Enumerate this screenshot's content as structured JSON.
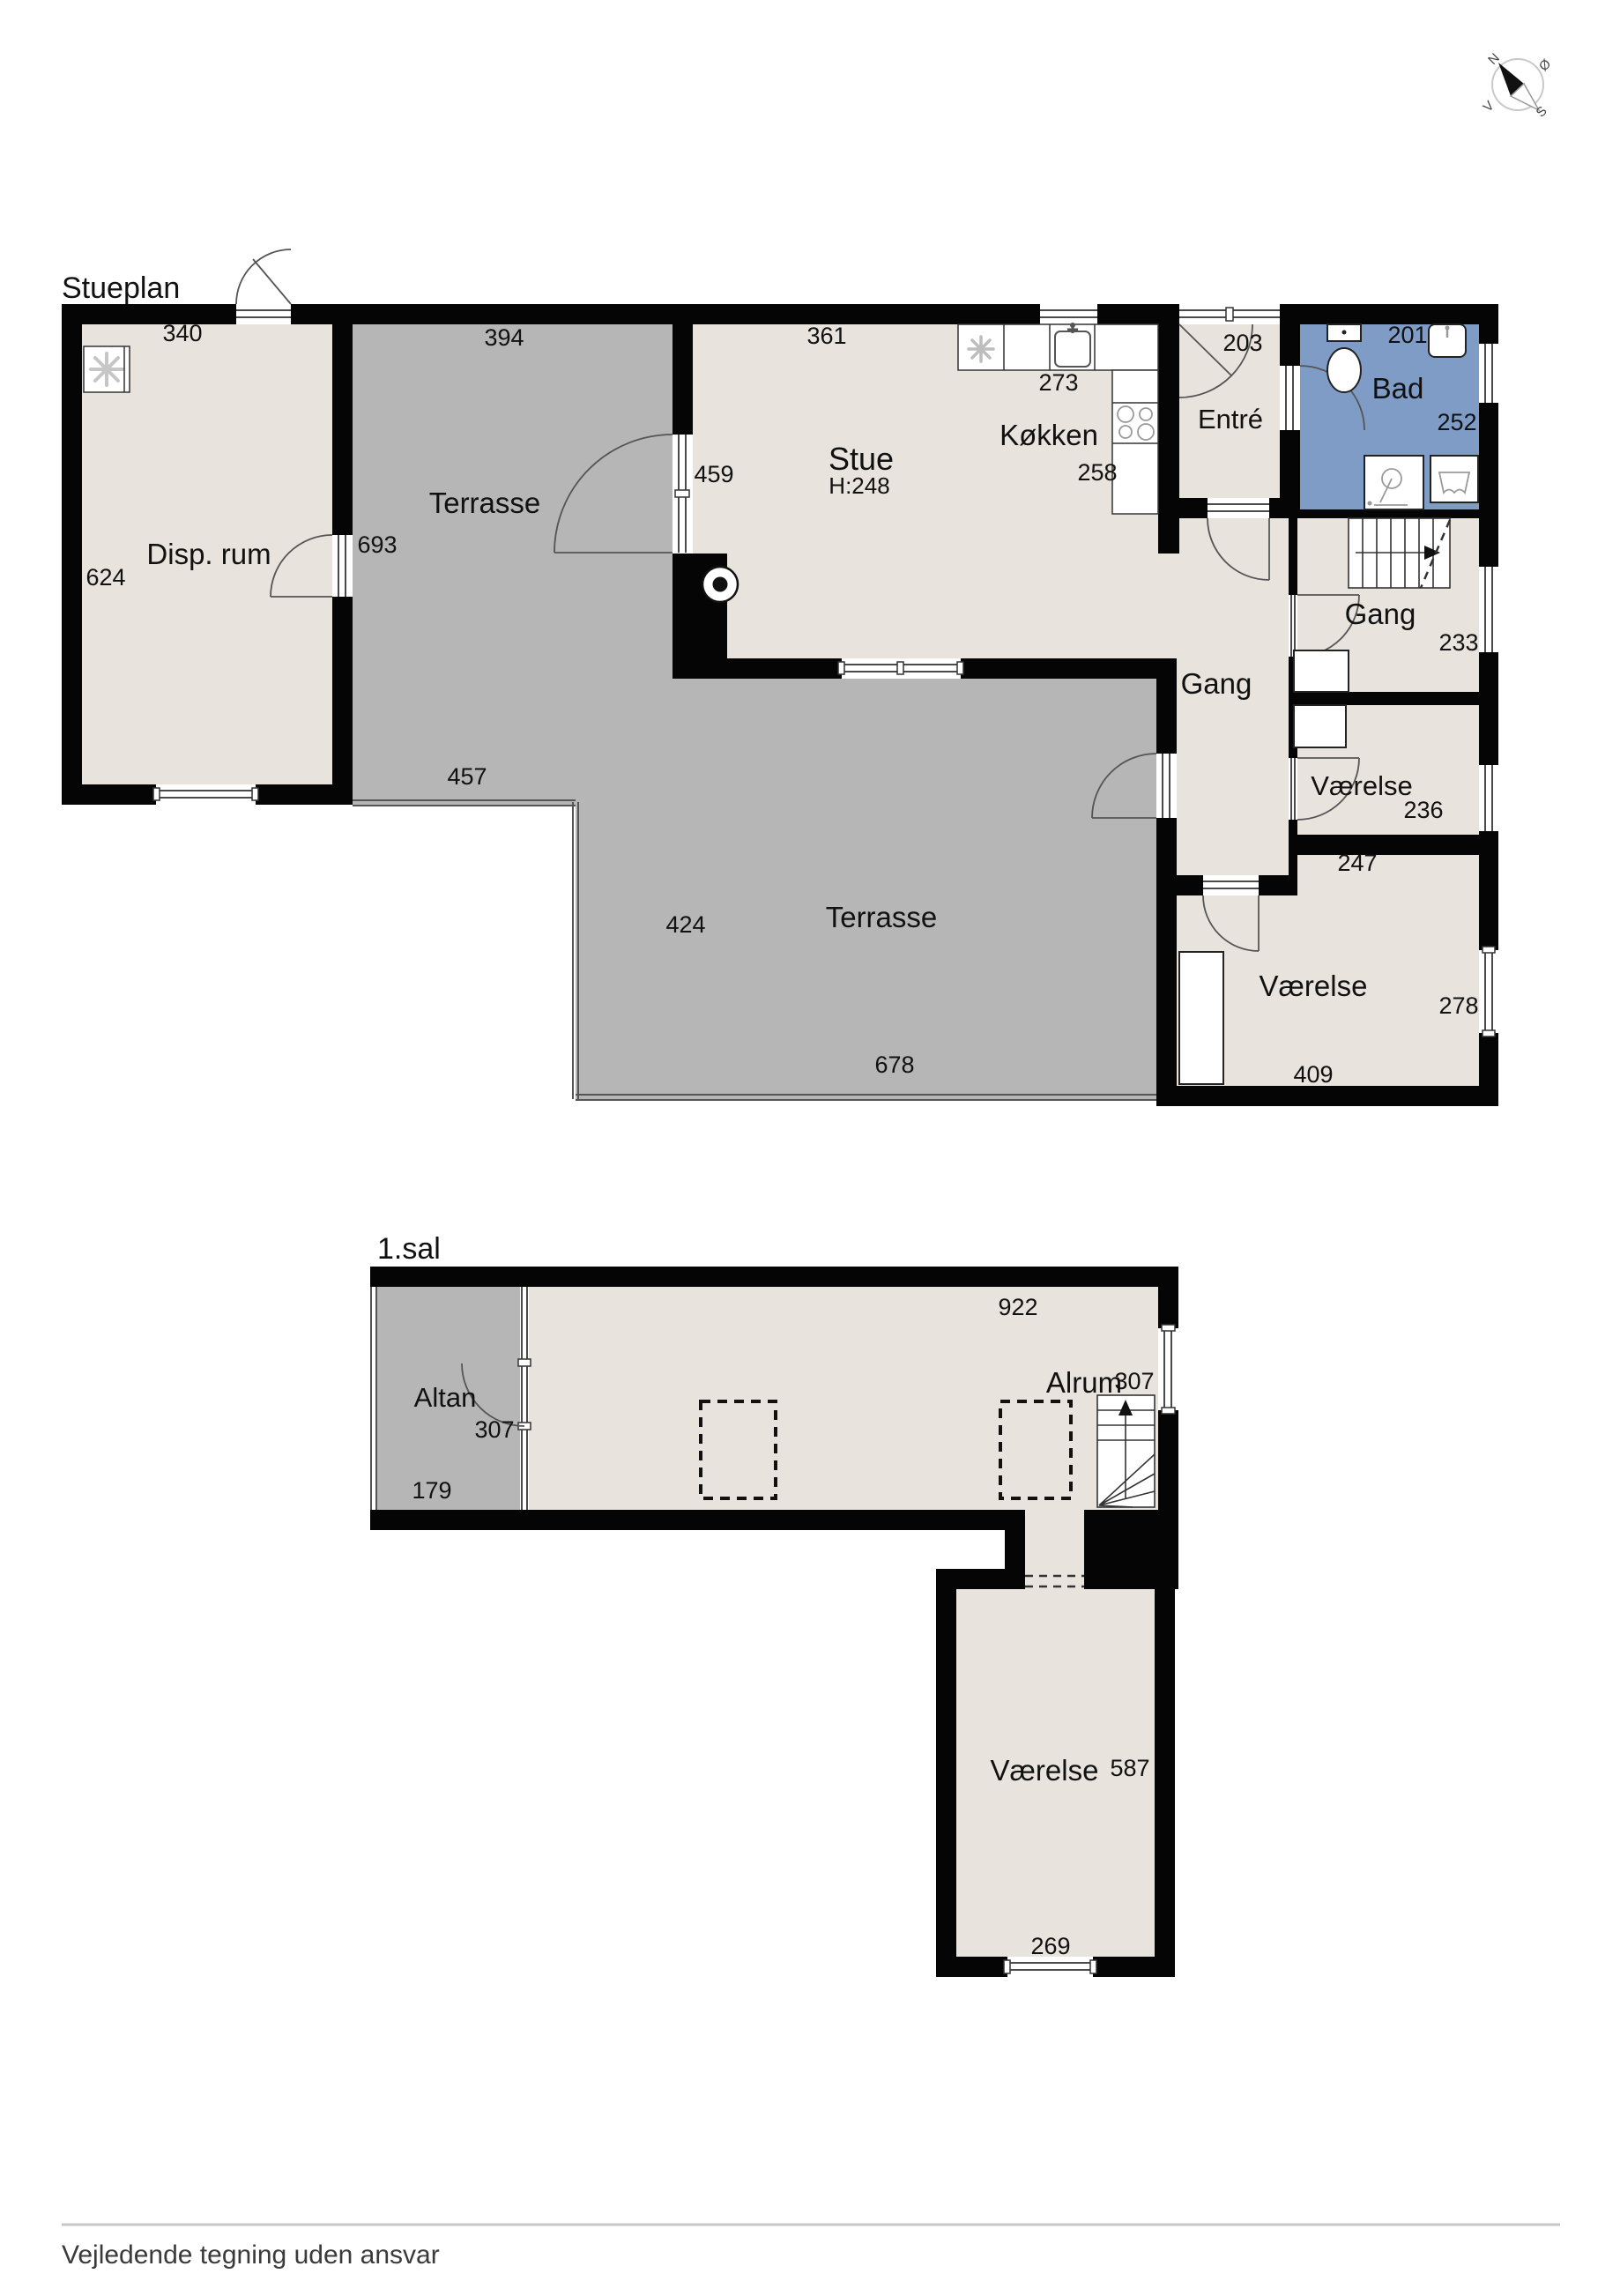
{
  "titles": {
    "ground": "Stueplan",
    "first": "1.sal"
  },
  "footer": {
    "disclaimer": "Vejledende tegning uden ansvar"
  },
  "compass": {
    "north": "N",
    "east": "Ø",
    "south": "S",
    "west": "V"
  },
  "ground": {
    "disp_rum": {
      "name": "Disp. rum",
      "dim_width": "340",
      "dim_depth": "624"
    },
    "terrasse_upper": {
      "name": "Terrasse",
      "dim_width": "394",
      "dim_left": "693",
      "dim_bottom": "457"
    },
    "stue": {
      "name": "Stue",
      "ceiling_height": "H:248",
      "dim_width": "361",
      "dim_door": "459"
    },
    "kokken": {
      "name": "Køkken",
      "dim_counter": "273",
      "dim_right": "258"
    },
    "entre": {
      "name": "Entré",
      "dim_door": "203"
    },
    "bad": {
      "name": "Bad",
      "dim_top": "201",
      "dim_right": "252"
    },
    "gang_mid": {
      "name": "Gang"
    },
    "gang_right": {
      "name": "Gang",
      "dim_right": "233"
    },
    "vaerelse_1": {
      "name": "Værelse",
      "dim_right": "236",
      "dim_bottom": "247"
    },
    "vaerelse_2": {
      "name": "Værelse",
      "dim_right": "278",
      "dim_bottom": "409"
    },
    "terrasse_lower": {
      "name": "Terrasse",
      "dim_left": "424",
      "dim_bottom": "678"
    }
  },
  "first": {
    "altan": {
      "name": "Altan",
      "dim_door": "307",
      "dim_bottom": "179"
    },
    "alrum": {
      "name": "Alrum",
      "dim_width": "922",
      "dim_stairs": "307"
    },
    "vaerelse": {
      "name": "Værelse",
      "dim_right": "587",
      "dim_bottom": "269"
    }
  }
}
